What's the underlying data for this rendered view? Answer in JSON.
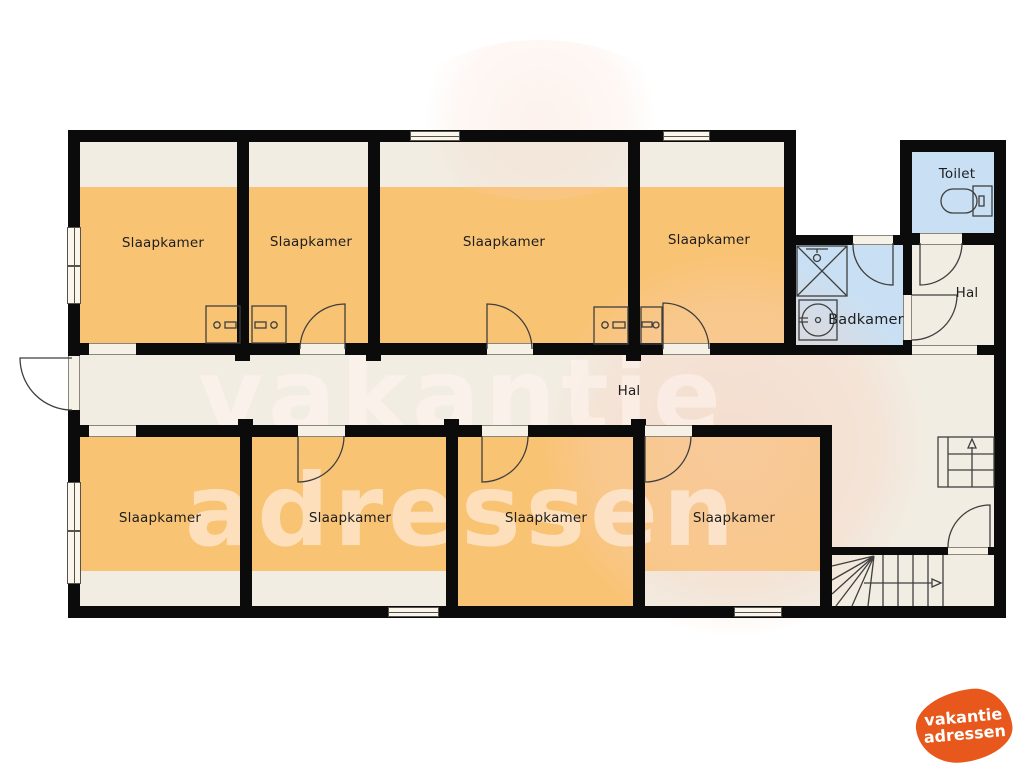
{
  "palette": {
    "room_orange": "#F9C374",
    "wet_room_blue": "#C9E0F4",
    "hall_cream": "#F2EDE3",
    "wall_black": "#0B0B0B",
    "line_gray": "#3F3F3F",
    "logo_orange": "#E8581C"
  },
  "rooms": {
    "bedrooms": [
      {
        "id": "slaapkamer-1",
        "label": "Slaapkamer"
      },
      {
        "id": "slaapkamer-2",
        "label": "Slaapkamer"
      },
      {
        "id": "slaapkamer-3",
        "label": "Slaapkamer"
      },
      {
        "id": "slaapkamer-4",
        "label": "Slaapkamer"
      },
      {
        "id": "slaapkamer-5",
        "label": "Slaapkamer"
      },
      {
        "id": "slaapkamer-6",
        "label": "Slaapkamer"
      },
      {
        "id": "slaapkamer-7",
        "label": "Slaapkamer"
      },
      {
        "id": "slaapkamer-8",
        "label": "Slaapkamer"
      }
    ],
    "hall_main": {
      "label": "Hal"
    },
    "hall_upper": {
      "label": "Hal"
    },
    "toilet": {
      "label": "Toilet"
    },
    "bathroom": {
      "label": "Badkamer"
    }
  },
  "stairs": {
    "upper_flight_arrow_direction": "up",
    "lower_flight_arrow_direction": "right"
  },
  "icons": {
    "toilet": "toilet-fixture-icon",
    "shower": "shower-square-x-icon",
    "washbasin": "washbasin-icon",
    "door": "quarter-arc-door-swing"
  },
  "watermark": {
    "line1": "vakantie",
    "line2": "adressen"
  },
  "logo": {
    "line1": "vakantie",
    "line2": "adressen"
  }
}
